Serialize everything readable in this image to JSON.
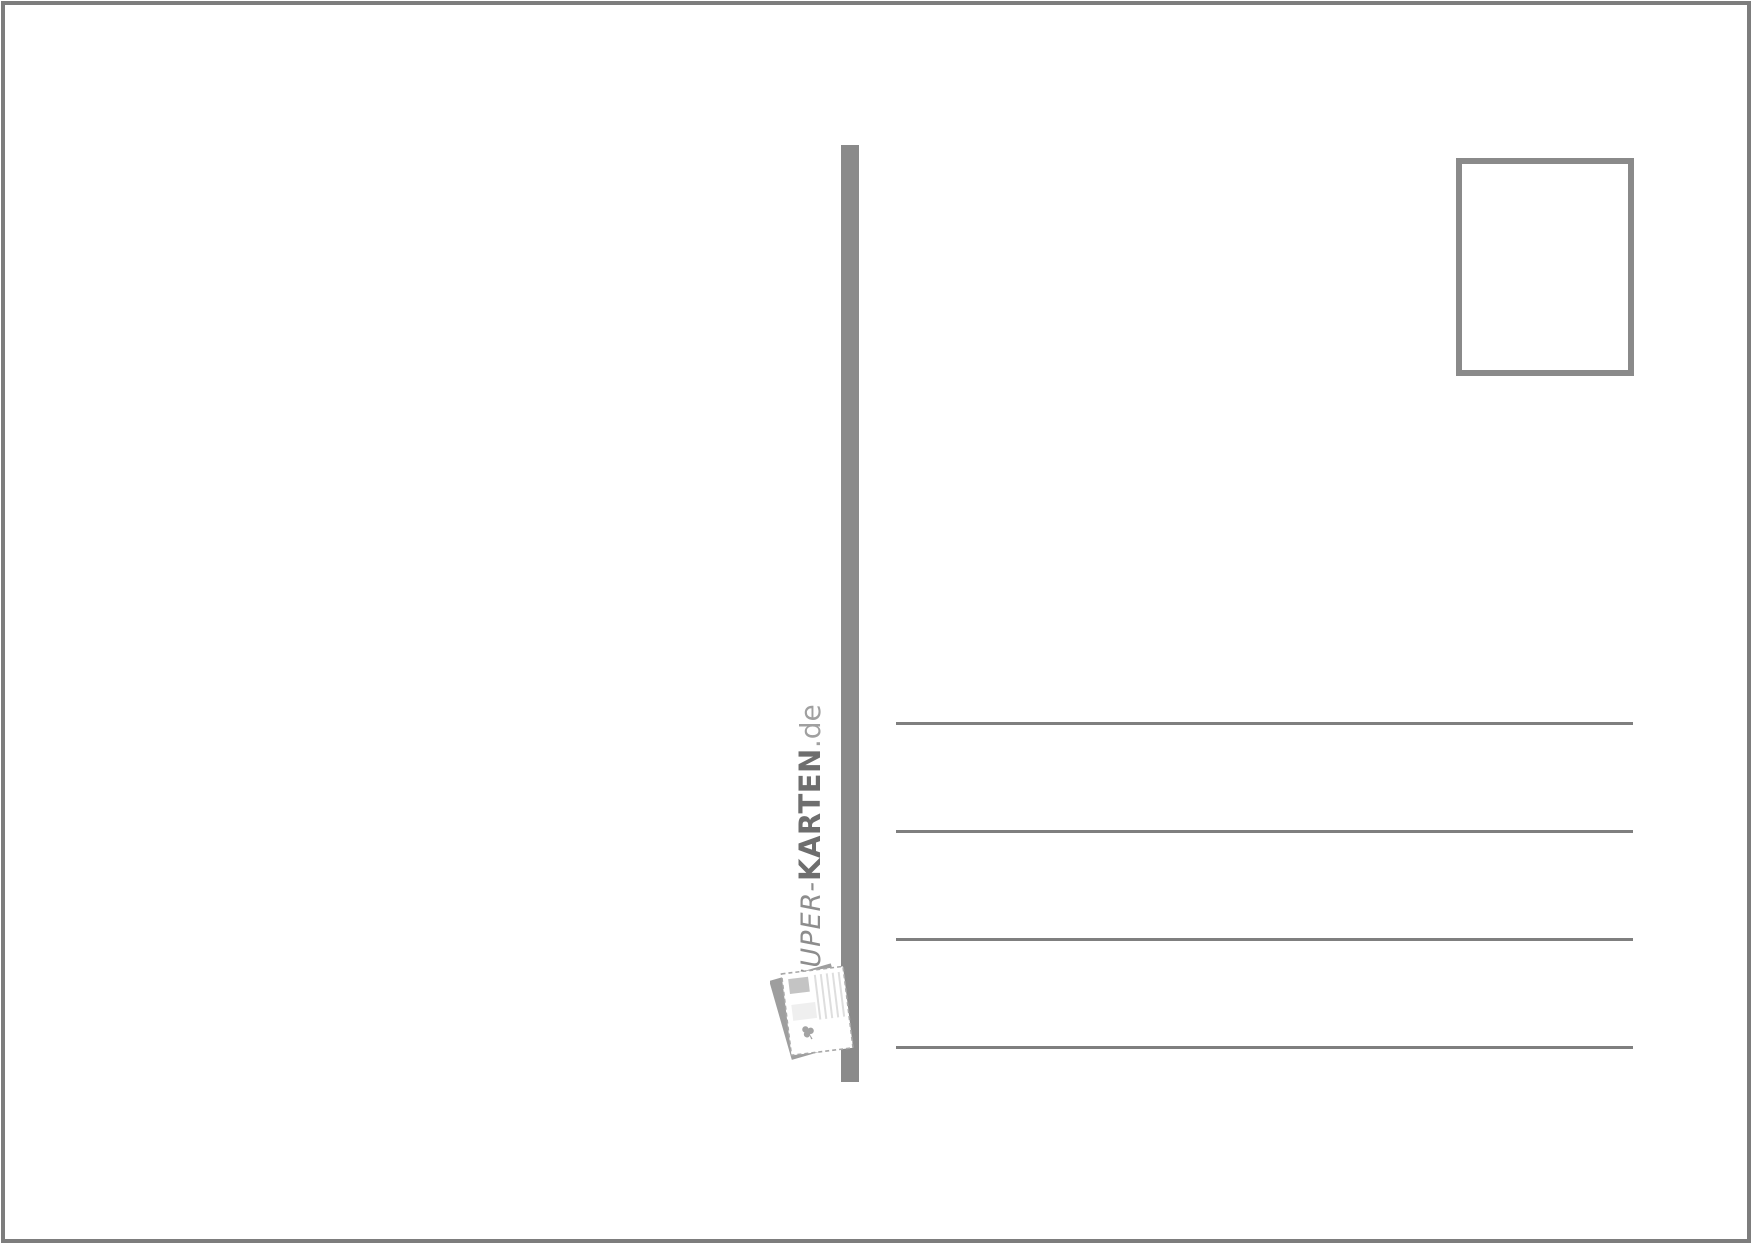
{
  "page": {
    "kind": "postcard-back-template",
    "background": "#ffffff"
  },
  "brand": {
    "prefix": "SUPER-",
    "name": "KARTEN",
    "tld": ".de"
  },
  "icons": {
    "postcard_logo": "postcard-icon"
  },
  "stamp_box": {
    "content": ""
  },
  "address_lines": {
    "count": 4
  },
  "colors": {
    "frame": "#7d7d7d",
    "divider": "#8a8a8a",
    "line": "#7f7f7f",
    "stamp_border": "#8a8a8a",
    "brand_prefix": "#8d8d8d",
    "brand_name": "#6e6e6e",
    "brand_tld": "#a0a0a0",
    "logo_back": "#9e9e9e",
    "logo_detail": "#c4c4c4"
  }
}
